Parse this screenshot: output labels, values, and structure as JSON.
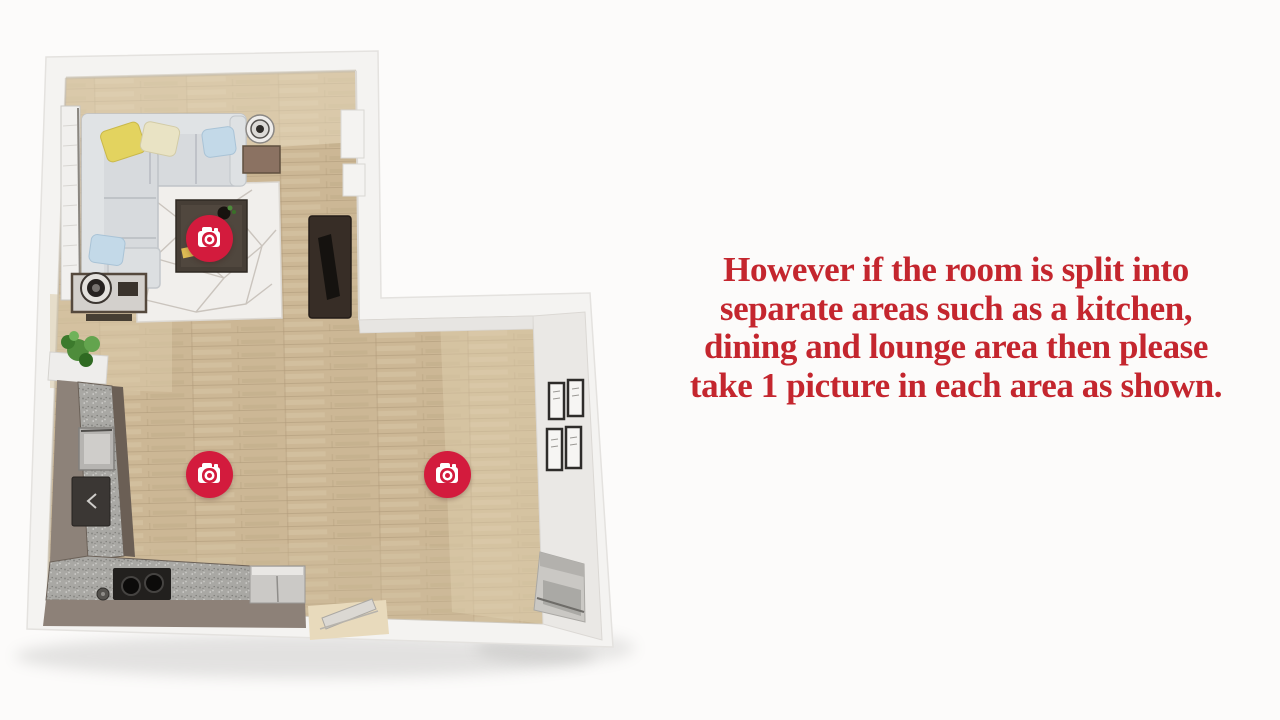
{
  "page": {
    "background_color": "#fcfbfa"
  },
  "instruction": {
    "lines": [
      "However if the room is split into",
      "separate areas such as a kitchen,",
      "dining and lounge area then please",
      "take 1 picture in each area as shown."
    ],
    "text_color": "#c4262e"
  },
  "floorplan": {
    "marker_color": "#d31b3d",
    "markers": [
      {
        "name": "camera-marker-lounge",
        "icon": "camera-icon",
        "x": 209,
        "y": 238
      },
      {
        "name": "camera-marker-kitchen",
        "icon": "camera-icon",
        "x": 209,
        "y": 474
      },
      {
        "name": "camera-marker-dining",
        "icon": "camera-icon",
        "x": 447,
        "y": 474
      }
    ],
    "colors": {
      "wall": "#f4f3f1",
      "wood_floor": "#ccb795",
      "counter_granite": "#a9a8a4",
      "sofa": "#d7dadd",
      "rug": "#f1efec"
    }
  }
}
